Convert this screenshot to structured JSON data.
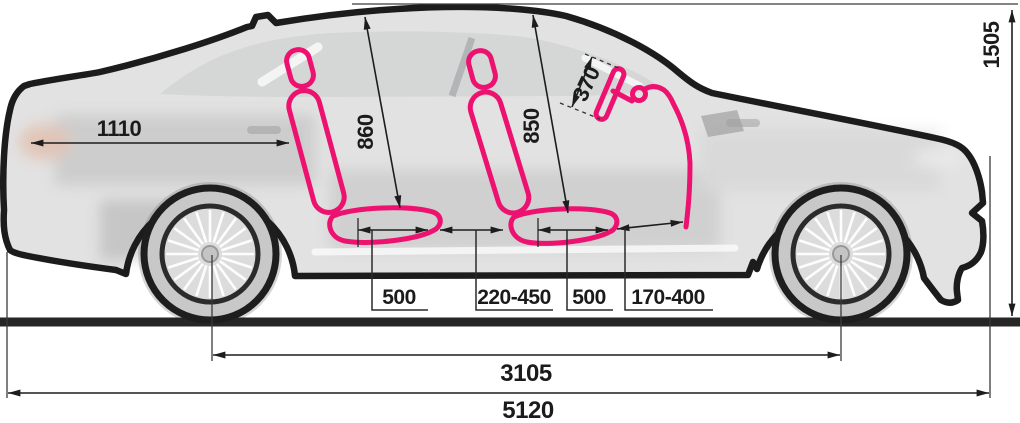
{
  "diagram": {
    "name": "sedan-side-view-interior-dimensions",
    "accent_color": "#ED1170",
    "line_color": "#1C1C1C",
    "dimensions": {
      "rear_overhang_to_seat": "1110",
      "rear_seat_to_roof": "860",
      "front_seat_to_roof": "850",
      "steering_wheel_diameter": "370",
      "rear_cushion_length": "500",
      "seat_gap_range": "220-450",
      "front_cushion_length": "500",
      "pedal_distance_range": "170-400",
      "wheelbase": "3105",
      "overall_length": "5120",
      "overall_height": "1505"
    }
  }
}
